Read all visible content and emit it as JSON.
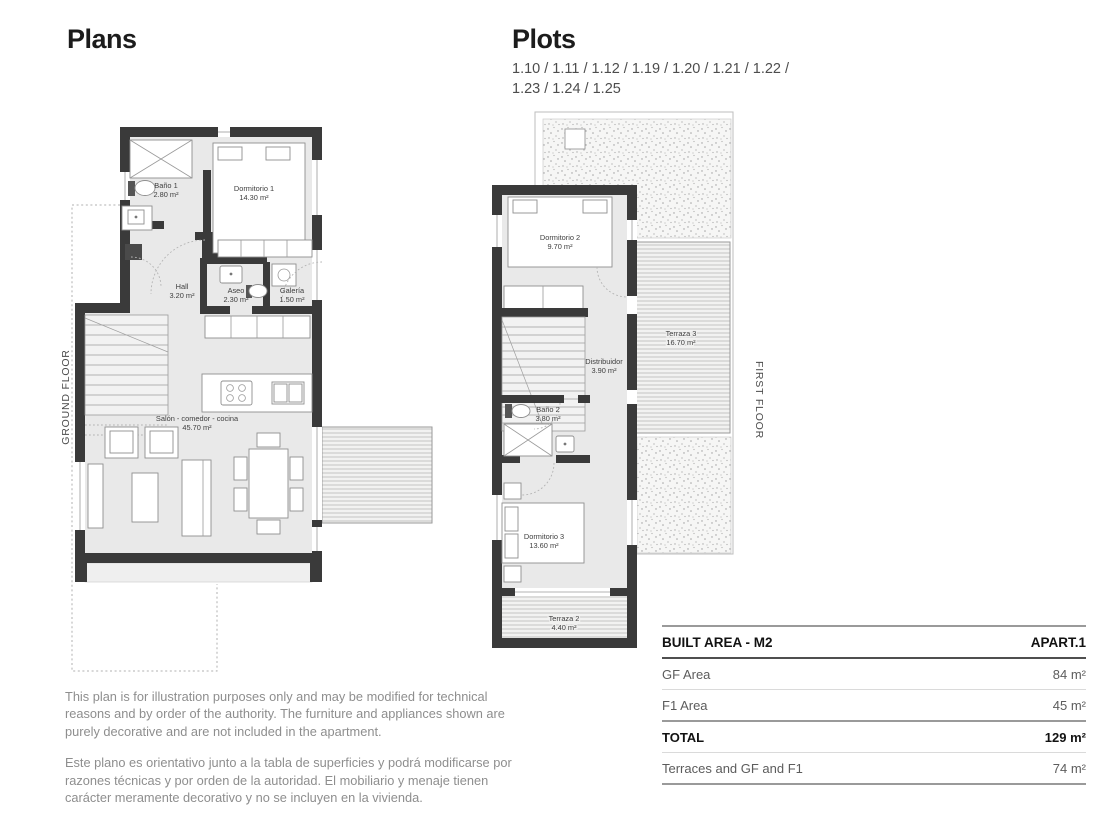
{
  "page": {
    "plans_title": "Plans",
    "plots_title": "Plots",
    "plots_line1": "1.10 / 1.11 / 1.12 / 1.19 / 1.20 / 1.21 / 1.22 /",
    "plots_line2": "1.23 / 1.24 / 1.25"
  },
  "palette": {
    "wall": "#3a3a3a",
    "floor_fill": "#e9e9e9",
    "furniture_line": "#8f8f8f",
    "deck_line": "#b9b9b9",
    "disclaimer_text": "#8e8e8e"
  },
  "ground_floor": {
    "label": "GROUND FLOOR",
    "rooms": {
      "bano1": {
        "name": "Baño 1",
        "area": "2.80 m²"
      },
      "dormitorio1": {
        "name": "Dormitorio 1",
        "area": "14.30 m²"
      },
      "hall": {
        "name": "Hall",
        "area": "3.20 m²"
      },
      "aseo": {
        "name": "Aseo",
        "area": "2.30 m²"
      },
      "galeria": {
        "name": "Galería",
        "area": "1.50 m²"
      },
      "salon": {
        "name": "Salón - comedor - cocina",
        "area": "45.70 m²"
      }
    }
  },
  "first_floor": {
    "label": "FIRST FLOOR",
    "rooms": {
      "dormitorio2": {
        "name": "Dormitorio 2",
        "area": "9.70 m²"
      },
      "distribuidor": {
        "name": "Distribuidor",
        "area": "3.90 m²"
      },
      "bano2": {
        "name": "Baño 2",
        "area": "3.80 m²"
      },
      "dormitorio3": {
        "name": "Dormitorio 3",
        "area": "13.60 m²"
      },
      "terraza2": {
        "name": "Terraza 2",
        "area": "4.40 m²"
      },
      "terraza3": {
        "name": "Terraza 3",
        "area": "16.70 m²"
      }
    }
  },
  "table": {
    "header": {
      "col1": "BUILT AREA - M2",
      "col2": "APART.1"
    },
    "rows": [
      {
        "label": "GF Area",
        "value": "84 m²"
      },
      {
        "label": "F1 Area",
        "value": "45 m²"
      },
      {
        "label": "TOTAL",
        "value": "129 m²"
      },
      {
        "label": "Terraces and GF and F1",
        "value": "74 m²"
      }
    ]
  },
  "disclaimer": {
    "english": "This plan is for illustration purposes only and may be modified for technical reasons and by order of the authority. The furniture and appliances shown are purely decorative and are not included in the apartment.",
    "spanish": "Este plano es orientativo junto a la tabla de superficies y podrá modificarse por razones técnicas y por orden de la autoridad. El mobiliario y menaje tienen carácter meramente decorativo y no se incluyen en la vivienda."
  }
}
